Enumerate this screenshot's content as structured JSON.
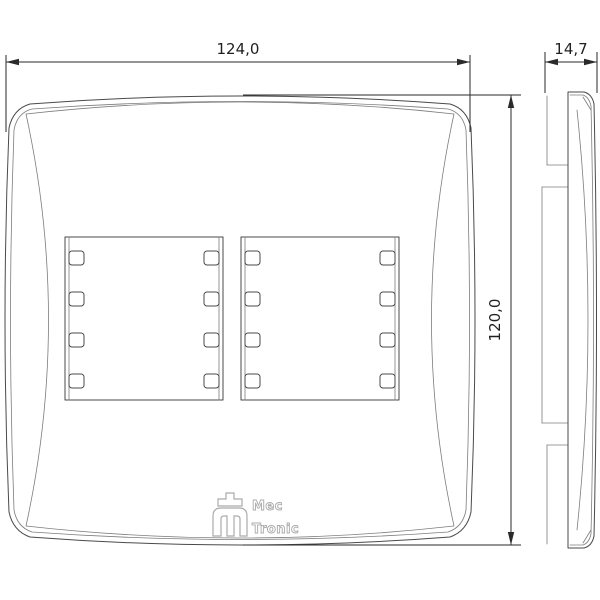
{
  "drawing": {
    "dimensions": {
      "width": "124,0",
      "height": "120,0",
      "depth": "14,7"
    },
    "logo": {
      "line1": "Mec",
      "line2": "Tronic"
    },
    "colors": {
      "geometry_line": "#4a4a4a",
      "dimension_line": "#2a2a2a",
      "logo": "#ababab",
      "background": "#ffffff"
    },
    "icons": {
      "logo_mark": "mectronic-m-logo"
    }
  }
}
